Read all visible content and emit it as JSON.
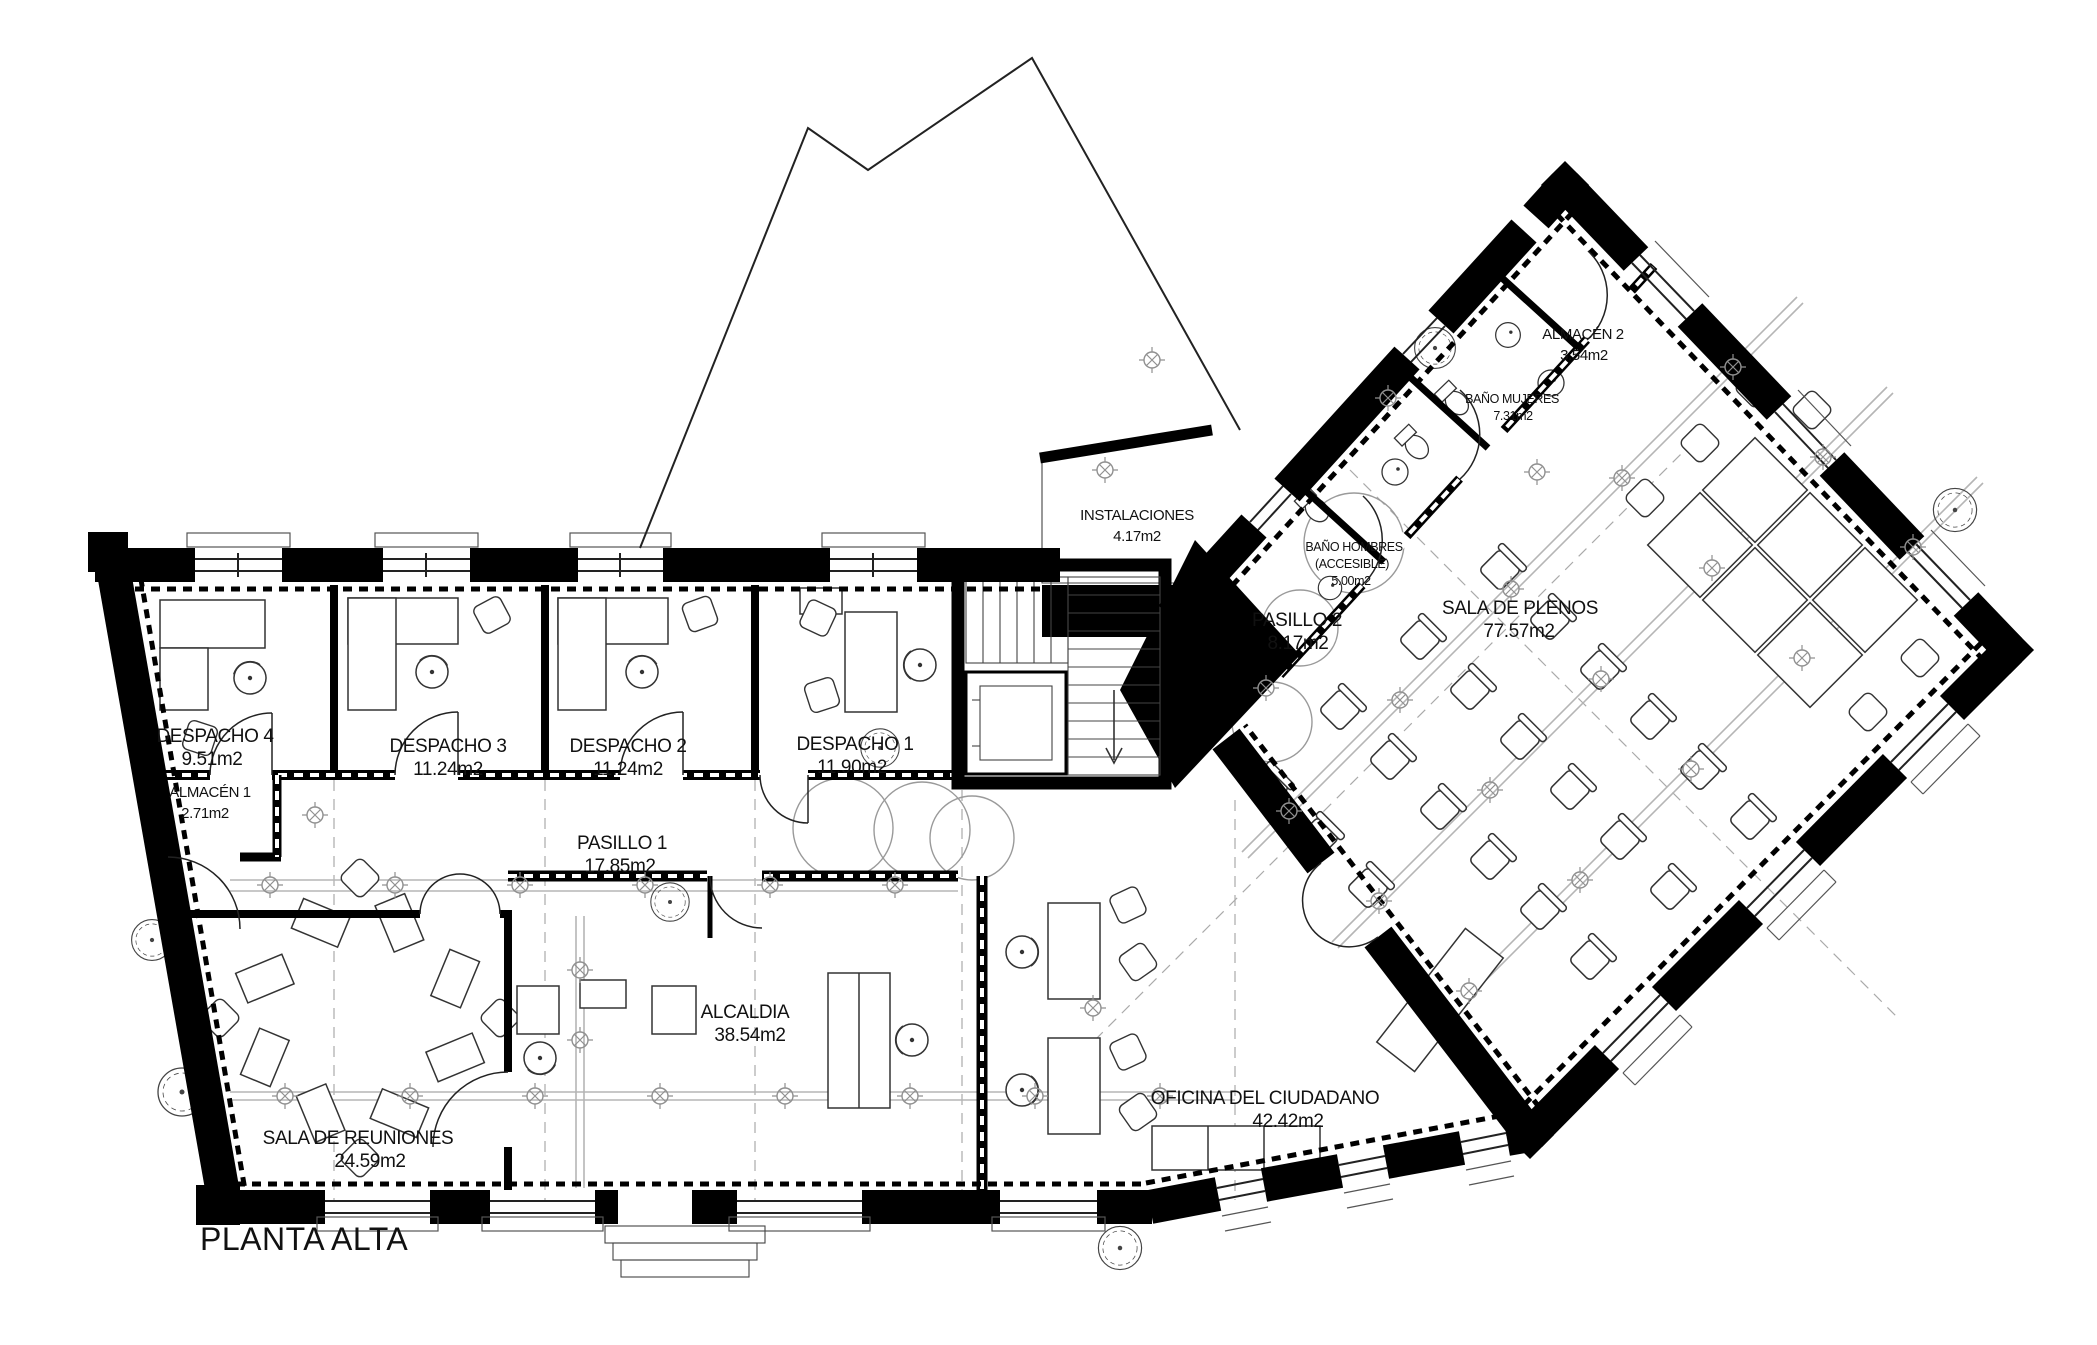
{
  "drawing": {
    "title": "PLANTA ALTA"
  },
  "rooms": {
    "despacho4": {
      "name": "DESPACHO 4",
      "area": "9.51m2"
    },
    "almacen1": {
      "name": "ALMACÉN 1",
      "area": "2.71m2"
    },
    "despacho3": {
      "name": "DESPACHO 3",
      "area": "11.24m2"
    },
    "despacho2": {
      "name": "DESPACHO 2",
      "area": "11.24m2"
    },
    "despacho1": {
      "name": "DESPACHO 1",
      "area": "11.90m2"
    },
    "pasillo1": {
      "name": "PASILLO 1",
      "area": "17.85m2"
    },
    "sala_reuniones": {
      "name": "SALA DE REUNIONES",
      "area": "24.59m2"
    },
    "alcaldia": {
      "name": "ALCALDIA",
      "area": "38.54m2"
    },
    "oficina_ciudadano": {
      "name": "OFICINA DEL CIUDADANO",
      "area": "42.42m2"
    },
    "instalaciones": {
      "name": "INSTALACIONES",
      "area": "4.17m2"
    },
    "pasillo2": {
      "name": "PASILLO 2",
      "area": "8.17m2"
    },
    "sala_plenos": {
      "name": "SALA DE PLENOS",
      "area": "77.57m2"
    },
    "almacen2": {
      "name": "ALMACÉN 2",
      "area": "3.54m2"
    },
    "bano_mujeres": {
      "name": "BAÑO MUJERES",
      "area": "7.31m2"
    },
    "bano_hombres": {
      "name": "BAÑO HOMBRES",
      "qualifier": "(ACCESIBLE)",
      "area": "5.00m2"
    }
  },
  "colors": {
    "wall": "#000000",
    "line": "#222222",
    "grid": "#9a9a9a",
    "background": "#ffffff"
  }
}
